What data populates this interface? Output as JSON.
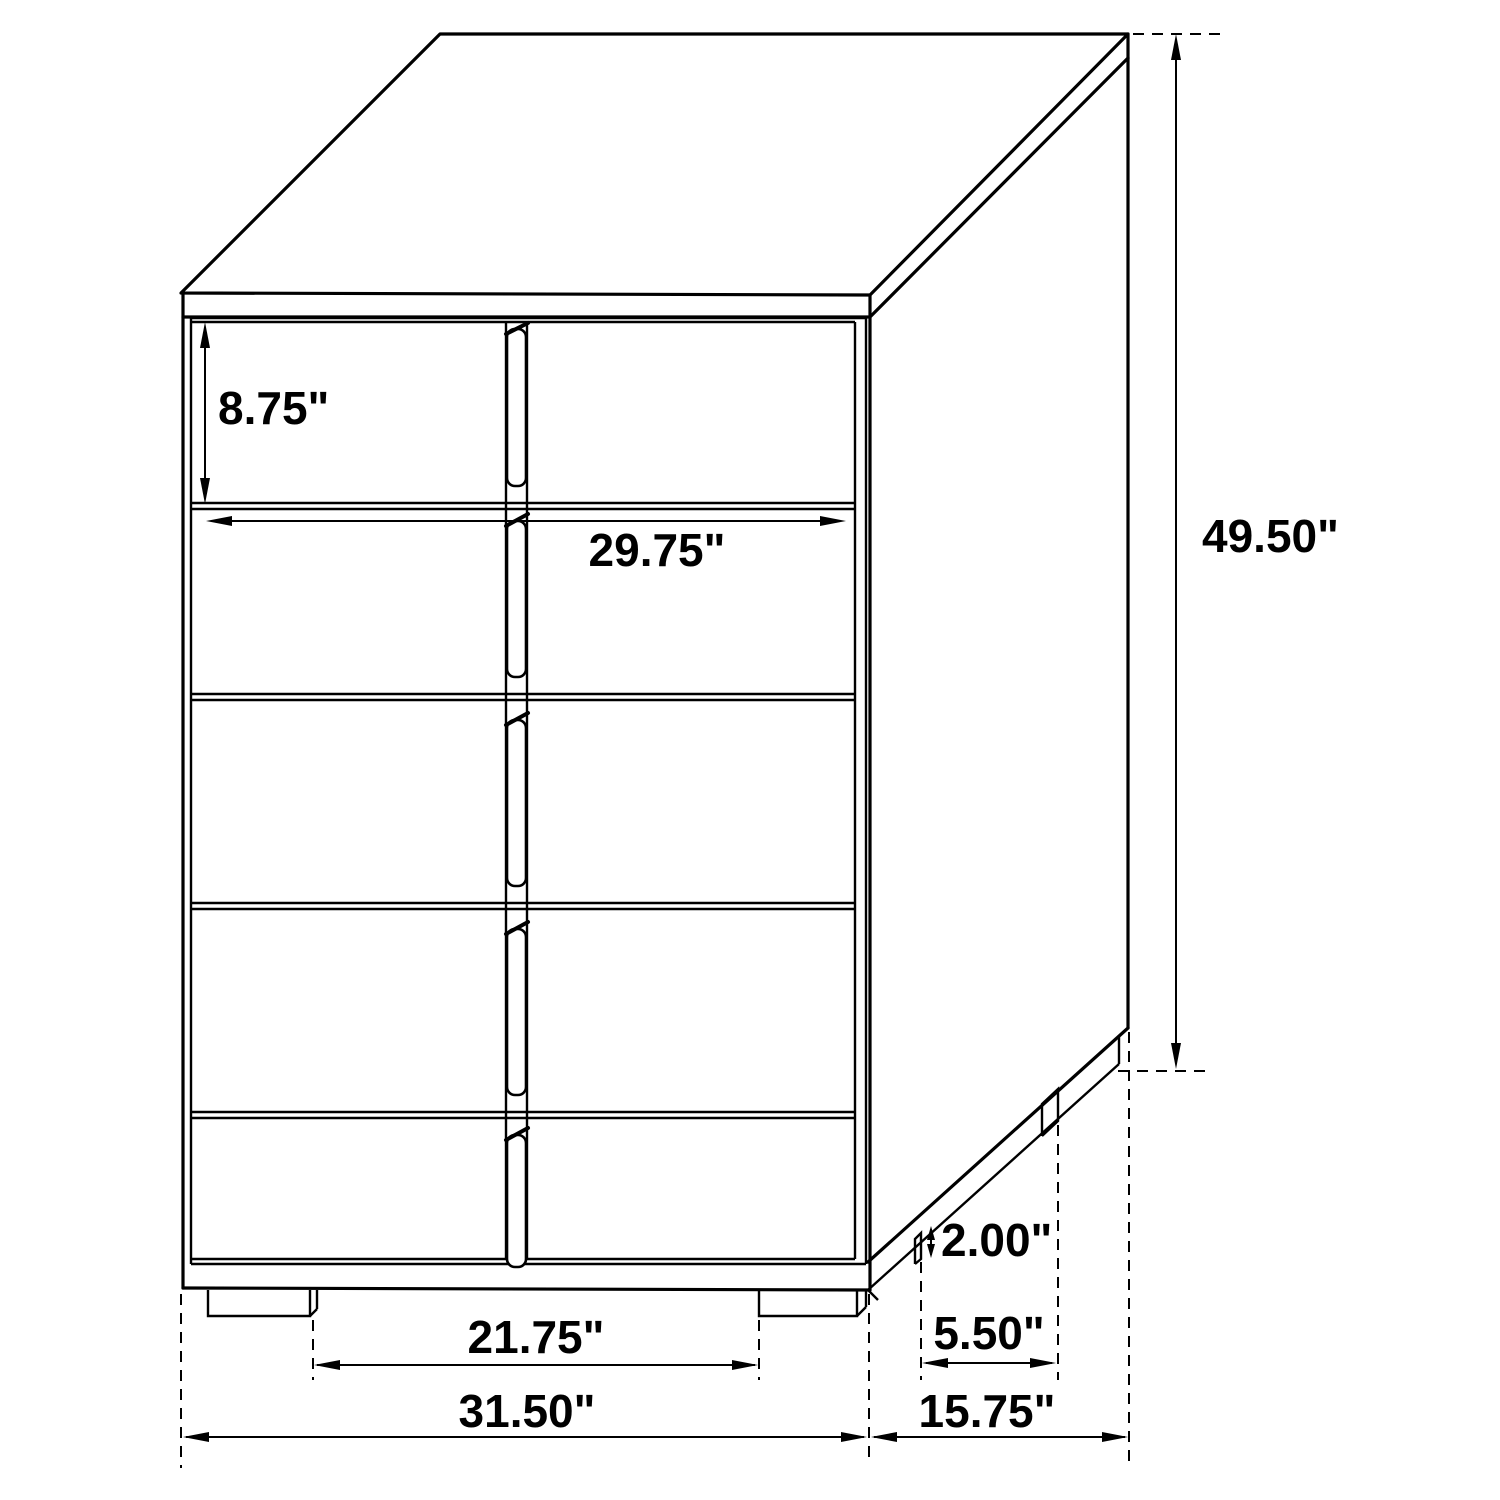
{
  "diagram": {
    "type": "furniture-dimension-drawing",
    "subject": "five-drawer-chest",
    "unit": "inches",
    "colors": {
      "line": "#000000",
      "background": "#ffffff",
      "text": "#000000"
    },
    "labels": {
      "drawer_height": "8.75\"",
      "drawer_width": "29.75\"",
      "overall_height": "49.50\"",
      "foot_height": "2.00\"",
      "foot_spacing_depth": "5.50\"",
      "foot_spacing_width": "21.75\"",
      "overall_width": "31.50\"",
      "overall_depth": "15.75\""
    }
  }
}
